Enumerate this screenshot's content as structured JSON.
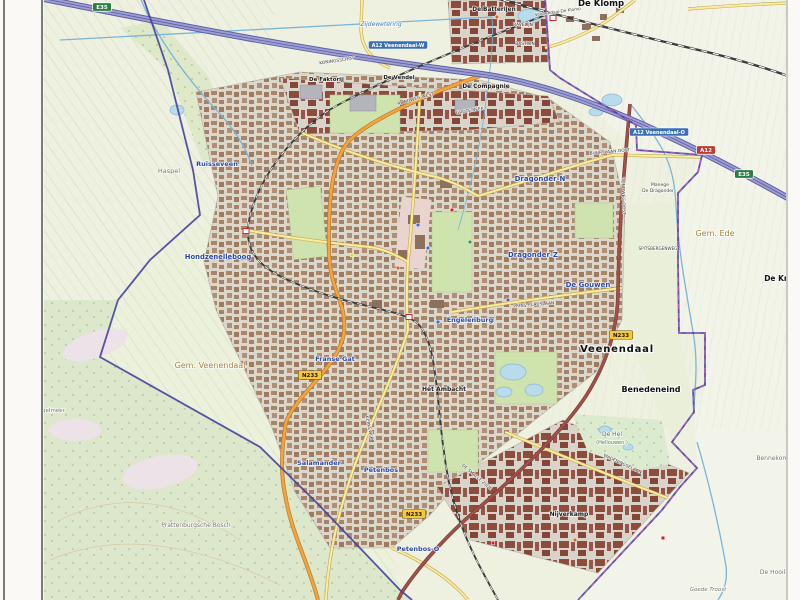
{
  "map_title": "Veenendaal",
  "palette": {
    "field": "#eef0e0",
    "field-light": "#f2f3e9",
    "meadow": "#e9efd9",
    "forest": "#dde7cc",
    "heath": "#ece2e8",
    "urban": "#dbd7cb",
    "bld-ind": "#8e4c3c",
    "park": "#cfe3ae",
    "water-line": "#7ab5d8",
    "water-fill": "#b9dcec",
    "water-label": "#3f7fae",
    "road-motorway": "#9e9ed2",
    "road-motorway-casing": "#5c5ca5",
    "road-orange": "#f5a33c",
    "road-orange-casing": "#b87a28",
    "road-maroon": "#a0524a",
    "road-maroon-casing": "#7e3c36",
    "road-yellow": "#ffeb9e",
    "road-yellow-casing": "#b9a94e",
    "rail": "#3a3a3a",
    "boundary-muni": "#4343a0",
    "boundary-prov": "#c05fc0",
    "label-blue": "#2b49a8",
    "label-muni": "#a2833e",
    "shield-red": "#c03b2f",
    "shield-green": "#2e7d43",
    "shield-yellow": "#f6c83c",
    "exit-blue": "#3b6fb5"
  },
  "labels": [
    {
      "text": "Veenendaal",
      "x": 617,
      "y": 352,
      "cls": "city",
      "size": 10,
      "ls": 0.8
    },
    {
      "text": "Benedeneind",
      "x": 651,
      "y": 392,
      "cls": "town",
      "size": 8
    },
    {
      "text": "De Klomp",
      "x": 601,
      "y": 6,
      "cls": "town",
      "size": 8.5
    },
    {
      "text": "De Kraats",
      "x": 785,
      "y": 281,
      "cls": "town",
      "size": 7.5
    },
    {
      "text": "De Batterijen",
      "x": 494,
      "y": 11,
      "cls": "area",
      "size": 5.8
    },
    {
      "text": "De Faktorij",
      "x": 326,
      "y": 81,
      "cls": "area",
      "size": 5.5
    },
    {
      "text": "De Vendel",
      "x": 399,
      "y": 79,
      "cls": "area",
      "size": 5.5
    },
    {
      "text": "De Compagnie",
      "x": 486,
      "y": 88,
      "cls": "area",
      "size": 5.8
    },
    {
      "text": "Nijverkamp",
      "x": 569,
      "y": 516,
      "cls": "area",
      "size": 6
    },
    {
      "text": "Het Ambacht",
      "x": 444,
      "y": 391,
      "cls": "area",
      "size": 6
    },
    {
      "text": "Ruisseveen",
      "x": 217,
      "y": 166,
      "cls": "hood",
      "size": 6.5
    },
    {
      "text": "Hondzenelleboog",
      "x": 218,
      "y": 259,
      "cls": "hood",
      "size": 6.8
    },
    {
      "text": "Dragonder-N",
      "x": 540,
      "y": 181,
      "cls": "hood",
      "size": 7
    },
    {
      "text": "Dragonder-Z",
      "x": 533,
      "y": 257,
      "cls": "hood",
      "size": 7
    },
    {
      "text": "De Gouwen",
      "x": 588,
      "y": 287,
      "cls": "hood",
      "size": 7
    },
    {
      "text": "Engelenburg",
      "x": 470,
      "y": 322,
      "cls": "hood",
      "size": 6.5
    },
    {
      "text": "Franse Gat",
      "x": 335,
      "y": 361,
      "cls": "hood",
      "size": 6.5
    },
    {
      "text": "Salamander",
      "x": 319,
      "y": 465,
      "cls": "hood",
      "size": 6.5
    },
    {
      "text": "Petenbos",
      "x": 381,
      "y": 472,
      "cls": "hood",
      "size": 6.5
    },
    {
      "text": "Petenbos-O",
      "x": 418,
      "y": 551,
      "cls": "hood",
      "size": 6.5
    },
    {
      "text": "Gem. Veenendaal",
      "x": 210,
      "y": 368,
      "cls": "muni",
      "size": 8
    },
    {
      "text": "Gem. Ede",
      "x": 715,
      "y": 236,
      "cls": "muni",
      "size": 8
    },
    {
      "text": "Haspel",
      "x": 169,
      "y": 173,
      "cls": "gray",
      "size": 6.5
    },
    {
      "text": "Prattenburgsche Bosch",
      "x": 196,
      "y": 527,
      "cls": "gray",
      "size": 6
    },
    {
      "text": "Het Egelmeer",
      "x": 46,
      "y": 412,
      "cls": "gray",
      "size": 5.5
    },
    {
      "text": "Goede Troost",
      "x": 708,
      "y": 591,
      "cls": "grayi",
      "size": 5.5
    },
    {
      "text": "De Hooilanden",
      "x": 782,
      "y": 574,
      "cls": "gray",
      "size": 6
    },
    {
      "text": "Bennekomse Meent",
      "x": 786,
      "y": 460,
      "cls": "gray",
      "size": 6
    },
    {
      "text": "De Hel",
      "x": 612,
      "y": 436,
      "cls": "nature",
      "size": 6
    },
    {
      "text": "(Hellouwen.)",
      "x": 612,
      "y": 444,
      "cls": "nature",
      "size": 5
    },
    {
      "text": "Zijdewetering",
      "x": 381,
      "y": 26,
      "cls": "water",
      "size": 6
    },
    {
      "text": "Veenendaal-De Klomp",
      "x": 558,
      "y": 13,
      "cls": "street",
      "size": 4.2,
      "rot": -8
    },
    {
      "text": "Manege",
      "x": 660,
      "y": 186,
      "cls": "street",
      "size": 4.5
    },
    {
      "text": "De Dragonder",
      "x": 658,
      "y": 192,
      "cls": "street",
      "size": 4.5
    },
    {
      "text": "KONINGSSCHOT",
      "x": 337,
      "y": 62,
      "cls": "street",
      "size": 4.4,
      "rot": -8
    },
    {
      "text": "RONDWEG-WEST",
      "x": 416,
      "y": 100,
      "cls": "street",
      "size": 4.4,
      "rot": -16
    },
    {
      "text": "GROTE BEEK",
      "x": 470,
      "y": 112,
      "cls": "street",
      "size": 4.4,
      "rot": -10
    },
    {
      "text": "BUURTLAAN OOST",
      "x": 610,
      "y": 153,
      "cls": "street",
      "size": 4.4,
      "rot": -5
    },
    {
      "text": "PRINS CLAUSLAAN",
      "x": 534,
      "y": 306,
      "cls": "street",
      "size": 4.4,
      "rot": -5
    },
    {
      "text": "RONDWEG-OOST",
      "x": 622,
      "y": 196,
      "cls": "street",
      "size": 4.4,
      "rot": 88
    },
    {
      "text": "DE SMALLE ZIJDE",
      "x": 476,
      "y": 478,
      "cls": "street",
      "size": 4.4,
      "rot": 40
    },
    {
      "text": "KERKEWIJK",
      "x": 368,
      "y": 428,
      "cls": "street",
      "size": 4.4,
      "rot": 78
    },
    {
      "text": "WAGENINGSELAAN",
      "x": 622,
      "y": 465,
      "cls": "street",
      "size": 4.4,
      "rot": 25
    },
    {
      "text": "SPITSBERGENWEG",
      "x": 658,
      "y": 250,
      "cls": "street",
      "size": 4.2
    },
    {
      "text": "RAVELIJN",
      "x": 523,
      "y": 26,
      "cls": "street",
      "size": 4.4
    },
    {
      "text": "BASTION",
      "x": 525,
      "y": 45,
      "cls": "street",
      "size": 4.4
    }
  ],
  "shields": [
    {
      "text": "A12",
      "type": "red",
      "x": 706,
      "y": 150
    },
    {
      "text": "E35",
      "type": "green",
      "x": 744,
      "y": 174
    },
    {
      "text": "E35",
      "type": "green",
      "x": 102,
      "y": 7
    },
    {
      "text": "N233",
      "type": "yellow",
      "x": 310,
      "y": 375
    },
    {
      "text": "N233",
      "type": "yellow",
      "x": 621,
      "y": 335
    },
    {
      "text": "N233",
      "type": "yellow",
      "x": 414,
      "y": 514
    }
  ],
  "exit_signs": [
    {
      "text": "A12 Veenendaal-W",
      "x": 398,
      "y": 45
    },
    {
      "text": "A12 Veenendaal-O",
      "x": 659,
      "y": 132
    }
  ],
  "stations": [
    {
      "x": 553,
      "y": 18
    },
    {
      "x": 246,
      "y": 231
    },
    {
      "x": 409,
      "y": 317
    }
  ],
  "pois": [
    {
      "x": 418,
      "y": 225,
      "color": "#2d6fd0"
    },
    {
      "x": 428,
      "y": 248,
      "color": "#2d6fd0"
    },
    {
      "x": 452,
      "y": 210,
      "color": "#cc2222"
    },
    {
      "x": 398,
      "y": 268,
      "color": "#d2622a"
    },
    {
      "x": 438,
      "y": 322,
      "color": "#2d6fd0"
    },
    {
      "x": 352,
      "y": 255,
      "color": "#e0d020"
    },
    {
      "x": 470,
      "y": 242,
      "color": "#2d9a3f"
    },
    {
      "x": 508,
      "y": 300,
      "color": "#8844aa"
    },
    {
      "x": 497,
      "y": 17,
      "color": "#d2622a"
    },
    {
      "x": 575,
      "y": 540,
      "color": "#d2622a"
    },
    {
      "x": 493,
      "y": 543,
      "color": "#cc2222"
    },
    {
      "x": 663,
      "y": 538,
      "color": "#cc2222"
    }
  ]
}
